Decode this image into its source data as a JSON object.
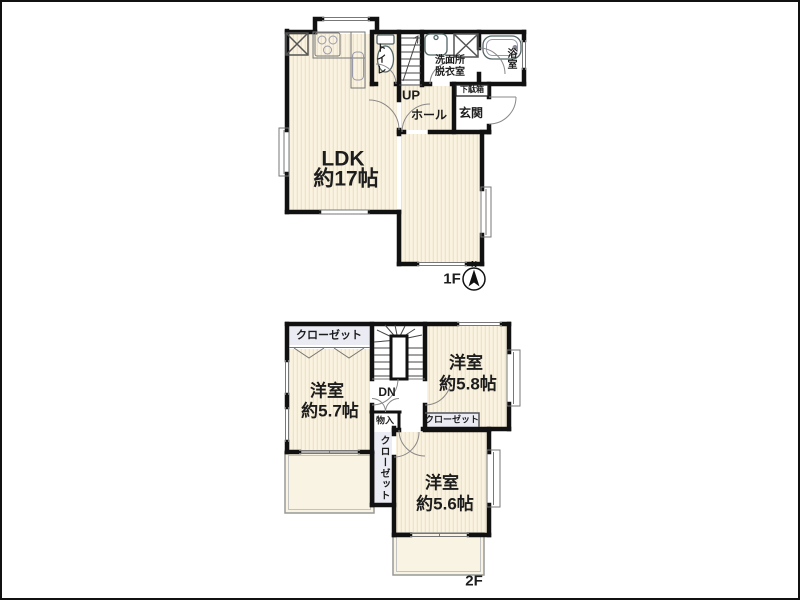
{
  "colors": {
    "bg": "#ffffff",
    "wall": "#111111",
    "room_fill": "#faf3e1",
    "room_stripe": "#efe3c4",
    "closet_fill": "#ebebf4",
    "balcony_fill": "#f8f3e2",
    "text": "#1d1d1d"
  },
  "floor1": {
    "label": "1F",
    "compass_north": "N",
    "ldk": [
      "LDK",
      "約17帖"
    ],
    "toilet": "トイレ",
    "stairs_up": "UP",
    "hall": "ホール",
    "entrance": "玄関",
    "shoe_cabinet": "下駄箱",
    "washroom": [
      "洗面所",
      "脱衣室"
    ],
    "bath": "浴室"
  },
  "floor2": {
    "label": "2F",
    "closet_nw": "クローゼット",
    "closet_e": "クローゼット",
    "closet_center": "クローゼット",
    "storage": "物入",
    "stairs_down": "DN",
    "room_west": [
      "洋室",
      "約5.7帖"
    ],
    "room_northeast": [
      "洋室",
      "約5.8帖"
    ],
    "room_southeast": [
      "洋室",
      "約5.6帖"
    ],
    "balcony_west": "バルコニー",
    "balcony_south": "バルコニー"
  }
}
